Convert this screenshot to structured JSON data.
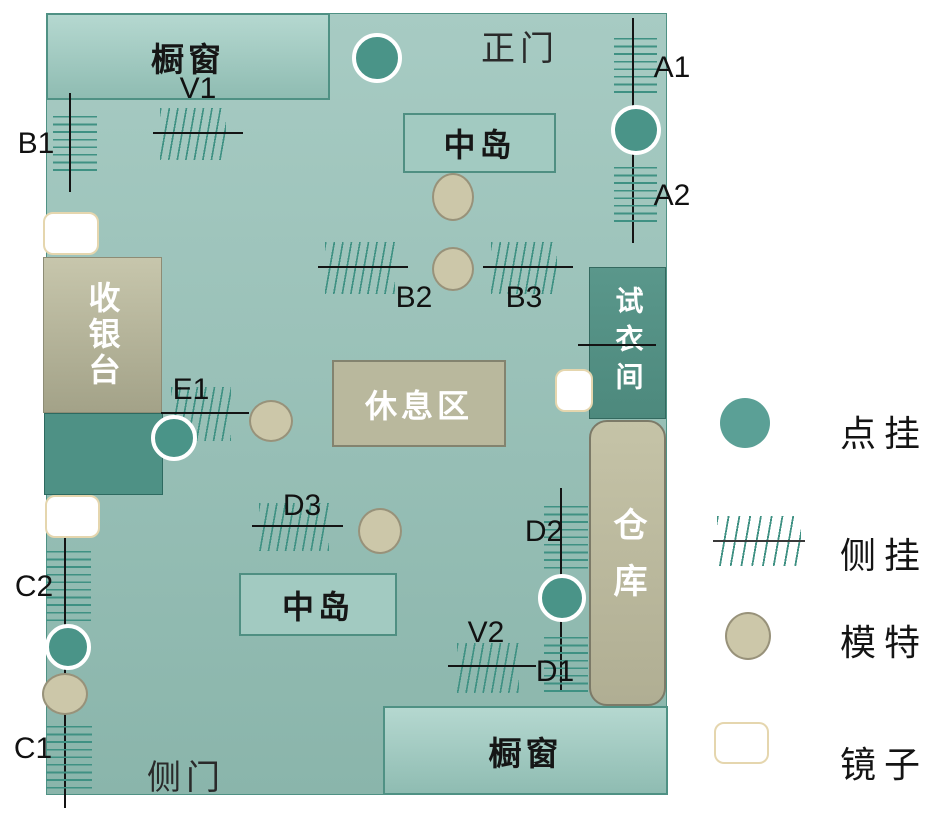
{
  "colors": {
    "floor_top": "#a7cbc3",
    "floor_bottom": "#8ab5ab",
    "window_fill_top": "#b5d8d0",
    "window_fill_bottom": "#8fbcb2",
    "window_border": "#4f9184",
    "island_fill": "#a2cac1",
    "island_border": "#4f8f82",
    "cashier_top": "#c7c6ac",
    "cashier_bottom": "#a3a288",
    "cashier_border": "#8d8c75",
    "rest_fill": "#b9b89d",
    "rest_border": "#83836f",
    "warehouse_top": "#c5c3a7",
    "warehouse_bottom": "#b0ae93",
    "warehouse_border": "#7c7a68",
    "fitting_top": "#5a978b",
    "fitting_bottom": "#4d897d",
    "fitting_border": "#34695f",
    "teal_block": "#4e9185",
    "teal_block_border": "#2d6a60",
    "dot": "#4a9488",
    "dot_legend": "#5ba096",
    "hatch": "#3f9183",
    "line": "#141414",
    "mannequin_fill": "#ccc7a9",
    "mannequin_border": "#98927a",
    "mirror_fill": "#ffffff",
    "mirror_border": "#e5d6ae"
  },
  "areas": {
    "window_top": {
      "label": "橱窗"
    },
    "island_top": {
      "label": "中岛"
    },
    "cashier": {
      "label": "收银台"
    },
    "rest_area": {
      "label": "休息区"
    },
    "fitting_room": {
      "label": "试衣间"
    },
    "warehouse": {
      "label": "仓库"
    },
    "island_bottom": {
      "label": "中岛"
    },
    "window_bottom": {
      "label": "橱窗"
    }
  },
  "doors": {
    "main": {
      "label": "正门"
    },
    "side": {
      "label": "侧门"
    }
  },
  "racks": [
    {
      "id": "V1",
      "orient": "h",
      "line": {
        "x": 153,
        "y": 133,
        "len": 90
      },
      "hatch": {
        "x": 160,
        "y": 108,
        "w": 66,
        "h": 52
      },
      "label": {
        "x": 198,
        "y": 89
      }
    },
    {
      "id": "B1",
      "orient": "v",
      "line": {
        "x": 70,
        "y": 93,
        "len": 99
      },
      "hatch": {
        "x": 53,
        "y": 116,
        "w": 44,
        "h": 60
      },
      "label": {
        "x": 36,
        "y": 144
      }
    },
    {
      "id": "A1",
      "orient": "v",
      "line": {
        "x": 633,
        "y": 18,
        "len": 225
      },
      "hatch": {
        "x": 614,
        "y": 38,
        "w": 43,
        "h": 56
      },
      "label": {
        "x": 672,
        "y": 68
      }
    },
    {
      "id": "A2",
      "orient": "v",
      "line": null,
      "hatch": {
        "x": 614,
        "y": 167,
        "w": 43,
        "h": 58
      },
      "label": {
        "x": 672,
        "y": 196
      }
    },
    {
      "id": "B2",
      "orient": "h",
      "line": {
        "x": 318,
        "y": 267,
        "len": 90
      },
      "hatch": {
        "x": 325,
        "y": 242,
        "w": 70,
        "h": 52
      },
      "label": {
        "x": 414,
        "y": 298
      }
    },
    {
      "id": "B3",
      "orient": "h",
      "line": {
        "x": 483,
        "y": 267,
        "len": 90
      },
      "hatch": {
        "x": 491,
        "y": 242,
        "w": 66,
        "h": 52
      },
      "label": {
        "x": 524,
        "y": 298
      }
    },
    {
      "id": "E1",
      "orient": "h",
      "line": {
        "x": 161,
        "y": 413,
        "len": 88
      },
      "hatch": {
        "x": 171,
        "y": 387,
        "w": 60,
        "h": 54
      },
      "label": {
        "x": 191,
        "y": 390
      }
    },
    {
      "id": "",
      "orient": "h",
      "line": {
        "x": 578,
        "y": 345,
        "len": 78
      },
      "hatch": null,
      "label": null
    },
    {
      "id": "D3",
      "orient": "h",
      "line": {
        "x": 252,
        "y": 526,
        "len": 91
      },
      "hatch": {
        "x": 259,
        "y": 503,
        "w": 70,
        "h": 48
      },
      "label": {
        "x": 302,
        "y": 506
      }
    },
    {
      "id": "C2",
      "orient": "v",
      "line": {
        "x": 65,
        "y": 538,
        "len": 270
      },
      "hatch": {
        "x": 46,
        "y": 551,
        "w": 45,
        "h": 70
      },
      "label": {
        "x": 34,
        "y": 587
      }
    },
    {
      "id": "C1",
      "orient": "v",
      "line": null,
      "hatch": {
        "x": 46,
        "y": 726,
        "w": 46,
        "h": 63
      },
      "label": {
        "x": 33,
        "y": 749
      }
    },
    {
      "id": "D2",
      "orient": "v",
      "line": {
        "x": 561,
        "y": 488,
        "len": 202
      },
      "hatch": {
        "x": 544,
        "y": 506,
        "w": 44,
        "h": 64
      },
      "label": {
        "x": 544,
        "y": 532
      }
    },
    {
      "id": "D1",
      "orient": "v",
      "line": null,
      "hatch": {
        "x": 544,
        "y": 637,
        "w": 44,
        "h": 55
      },
      "label": {
        "x": 555,
        "y": 672
      }
    },
    {
      "id": "V2",
      "orient": "h",
      "line": {
        "x": 448,
        "y": 666,
        "len": 88
      },
      "hatch": {
        "x": 457,
        "y": 643,
        "w": 62,
        "h": 50
      },
      "label": {
        "x": 486,
        "y": 633
      }
    }
  ],
  "fixtures": {
    "dots": [
      {
        "id": "entrance",
        "cx": 377,
        "cy": 58,
        "r": 21
      },
      {
        "id": "a",
        "cx": 636,
        "cy": 130,
        "r": 21
      },
      {
        "id": "e1",
        "cx": 174,
        "cy": 438,
        "r": 19
      },
      {
        "id": "c",
        "cx": 68,
        "cy": 647,
        "r": 19
      },
      {
        "id": "d",
        "cx": 562,
        "cy": 598,
        "r": 20
      }
    ],
    "mannequins": [
      {
        "cx": 453,
        "cy": 197,
        "rx": 21,
        "ry": 24
      },
      {
        "cx": 453,
        "cy": 269,
        "rx": 21,
        "ry": 22
      },
      {
        "cx": 271,
        "cy": 421,
        "rx": 22,
        "ry": 21
      },
      {
        "cx": 380,
        "cy": 531,
        "rx": 22,
        "ry": 23
      },
      {
        "cx": 65,
        "cy": 694,
        "rx": 23,
        "ry": 21
      }
    ],
    "mirrors": [
      {
        "x": 43,
        "y": 212,
        "w": 56,
        "h": 43
      },
      {
        "x": 45,
        "y": 495,
        "w": 55,
        "h": 43
      },
      {
        "x": 555,
        "y": 369,
        "w": 38,
        "h": 43
      }
    ]
  },
  "legend": {
    "items": [
      {
        "symbol": "point-hang",
        "label": "点挂"
      },
      {
        "symbol": "side-hang",
        "label": "侧挂"
      },
      {
        "symbol": "mannequin",
        "label": "模特"
      },
      {
        "symbol": "mirror",
        "label": "镜子"
      }
    ]
  }
}
